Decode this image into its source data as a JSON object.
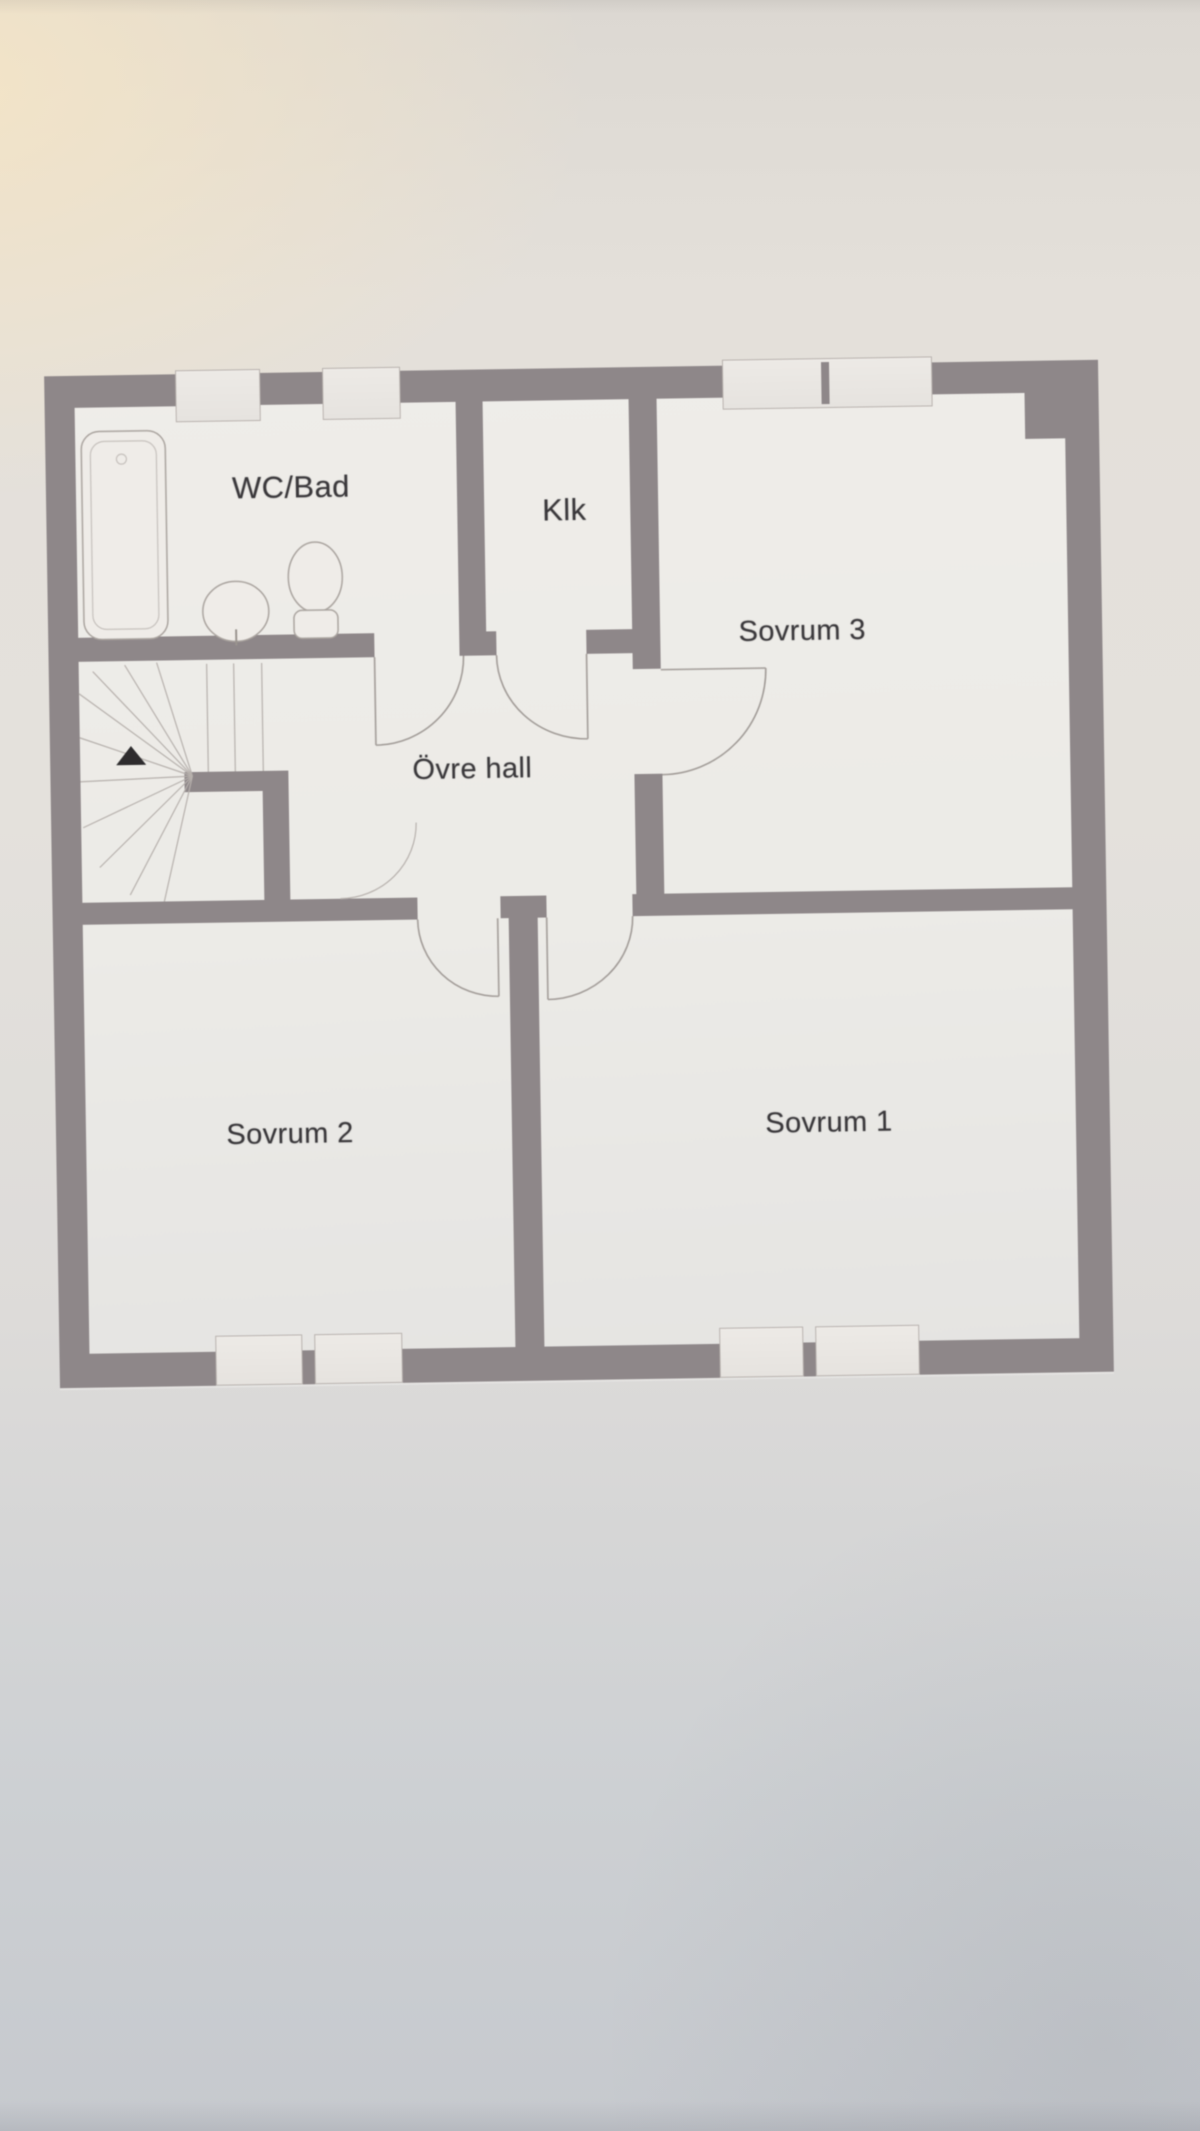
{
  "floor_plan": {
    "rooms": [
      {
        "id": "wc-bad",
        "label": "WC/Bad"
      },
      {
        "id": "klk",
        "label": "Klk"
      },
      {
        "id": "sovrum-3",
        "label": "Sovrum 3"
      },
      {
        "id": "ovre-hall",
        "label": "Övre hall"
      },
      {
        "id": "sovrum-2",
        "label": "Sovrum 2"
      },
      {
        "id": "sovrum-1",
        "label": "Sovrum 1"
      }
    ],
    "fixtures": [
      "bathtub",
      "washbasin",
      "toilet",
      "winder-staircase"
    ],
    "icons": {
      "stairs_direction": "up-arrow-triangle"
    },
    "colors": {
      "wall": "#8e8789",
      "floor": "#eceae6",
      "thin_line": "#a8a29d",
      "text": "#3a383b",
      "paper_warm_tint": "#f2e5c9",
      "paper_bottom": "#c8cbcf"
    }
  }
}
